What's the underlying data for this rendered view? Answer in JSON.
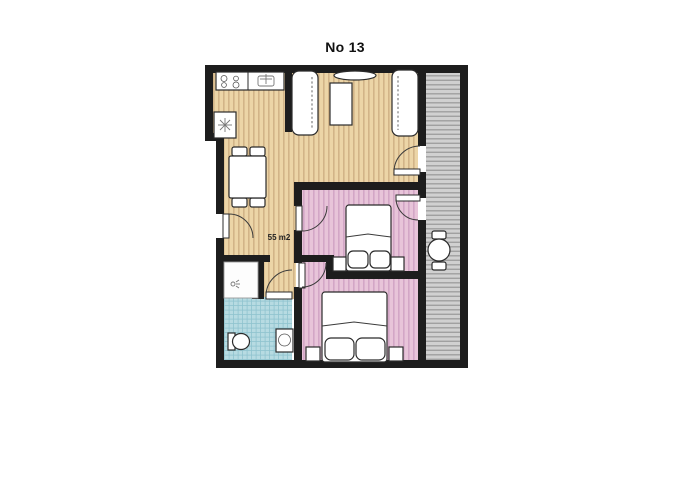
{
  "title": "No 13",
  "plan": {
    "area_label": "55 m2",
    "rooms": [
      "living-room-with-kitchen",
      "bedroom-1",
      "bedroom-2",
      "bathroom",
      "hallway",
      "shower",
      "balcony"
    ],
    "furniture_icons": [
      "kitchen-counter",
      "stove-burners",
      "sink",
      "washing-machine",
      "dining-table",
      "dining-chairs",
      "sofa",
      "sofa",
      "coffee-table",
      "tv",
      "double-bed",
      "double-bed",
      "nightstand",
      "nightstand",
      "nightstand",
      "nightstand",
      "toilet",
      "washbasin",
      "shower-tray",
      "balcony-round-table",
      "balcony-chair",
      "balcony-chair",
      "door",
      "door",
      "door",
      "door",
      "door",
      "door"
    ]
  },
  "palette": {
    "background": "#ffffff",
    "wall": "#1d1d1d",
    "wood_floor": "#ecd5a7",
    "wood_stripe": "#d2b488",
    "pink_floor": "#e8c4d9",
    "pink_stripe": "#d3a6c6",
    "tile_floor": "#b7dbe2",
    "tile_line": "#8fc3cf",
    "deck_floor": "#d0d0d0",
    "deck_line": "#a0a0a0",
    "furniture_fill": "#ffffff",
    "furniture_outline": "#2b2b2b"
  }
}
